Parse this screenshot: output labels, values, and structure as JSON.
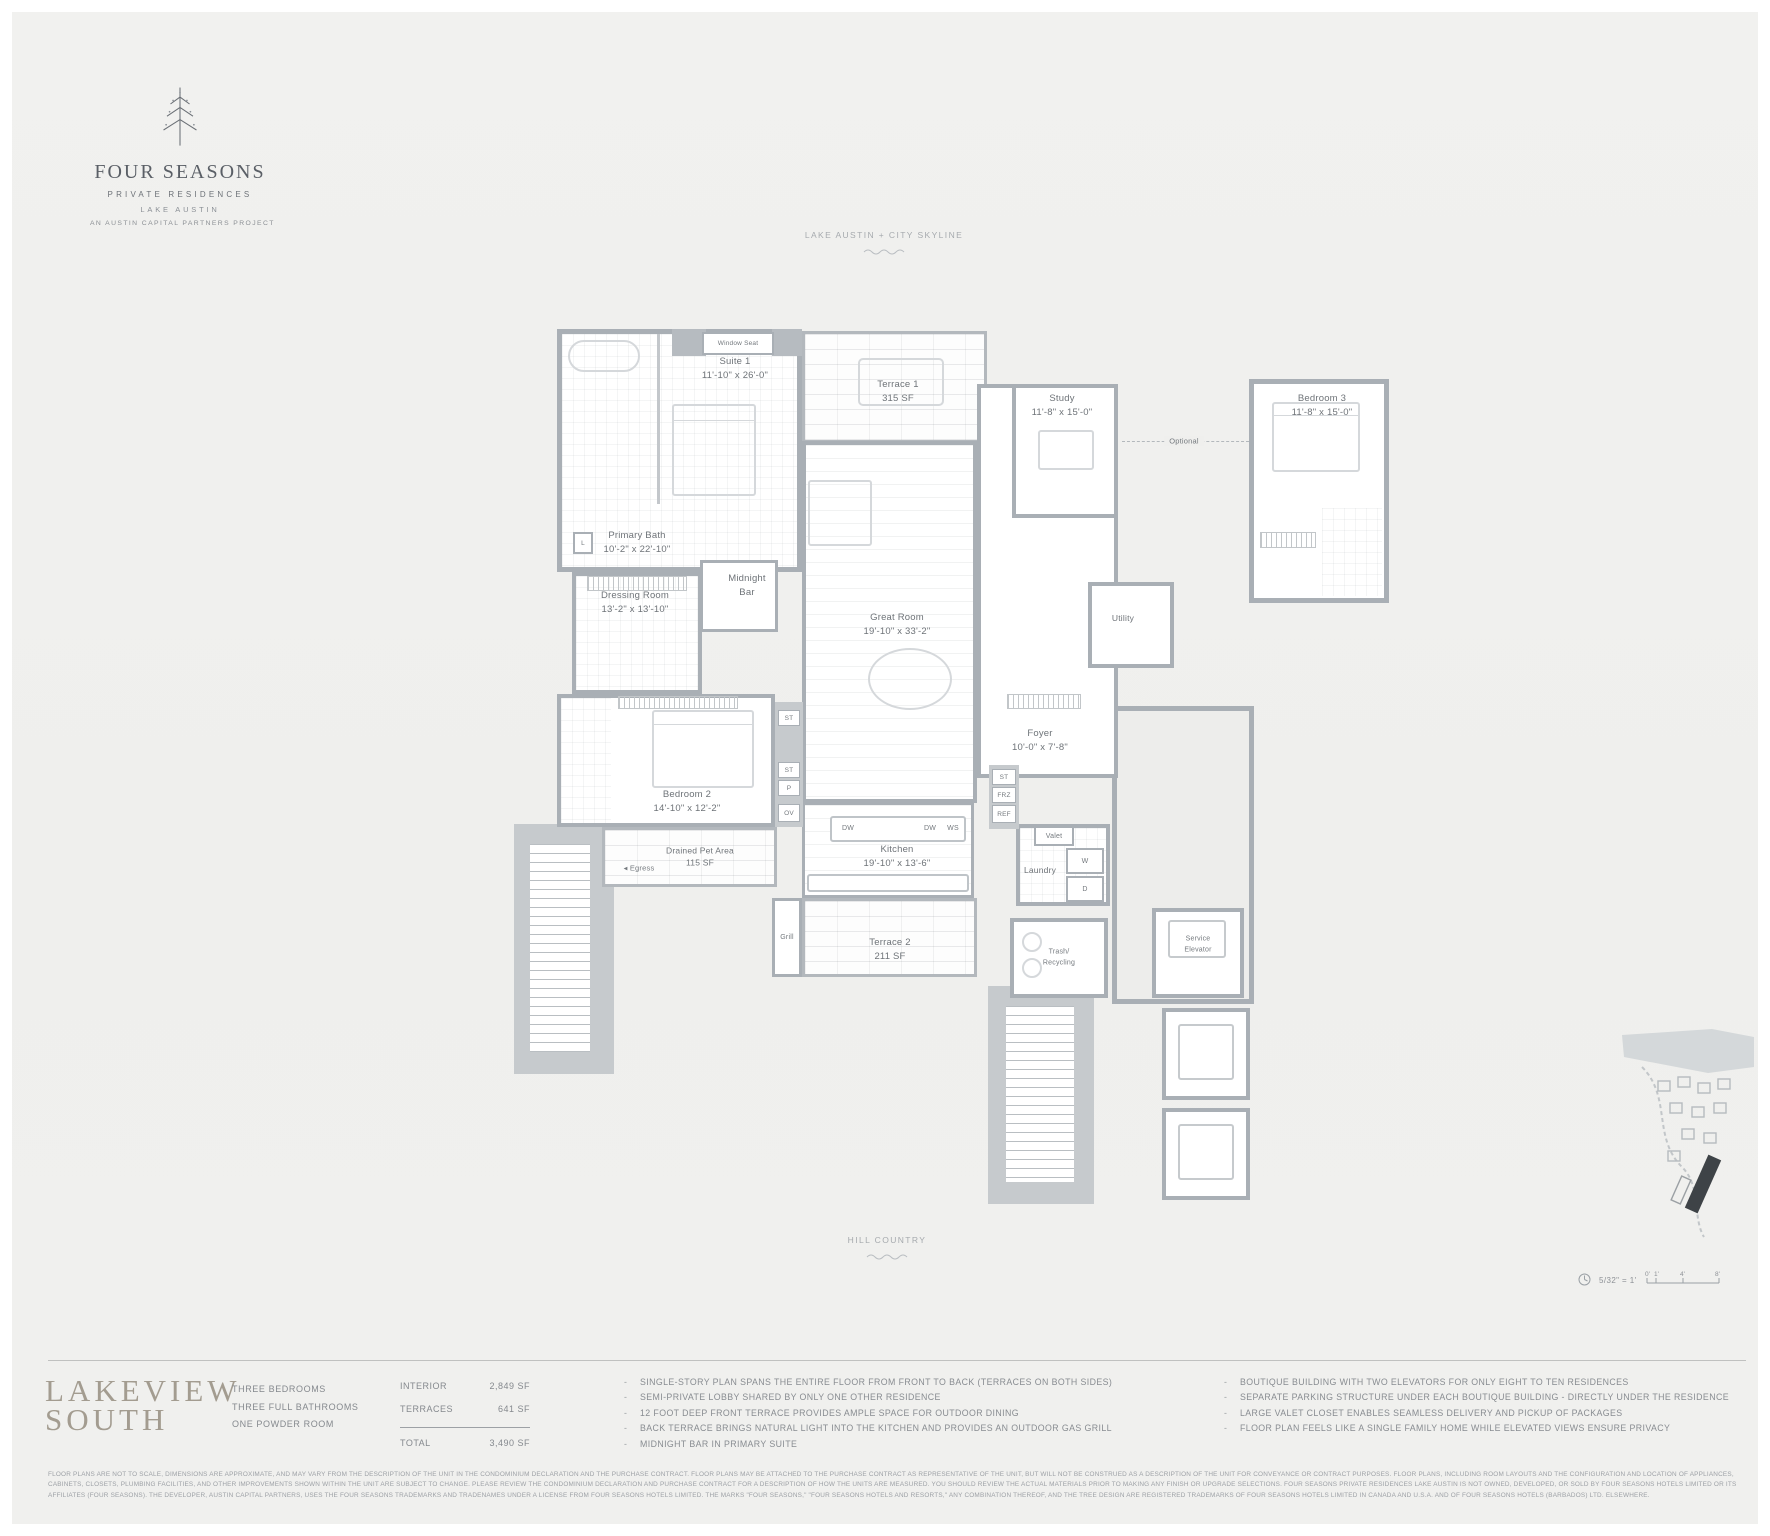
{
  "brand": {
    "four_seasons": "Four Seasons",
    "private_residences": "PRIVATE RESIDENCES",
    "lake_austin": "LAKE AUSTIN",
    "project": "AN AUSTIN CAPITAL PARTNERS PROJECT"
  },
  "orientation": {
    "top": "LAKE AUSTIN + CITY SKYLINE",
    "bottom": "HILL COUNTRY"
  },
  "plan": {
    "rooms": {
      "suite1": {
        "name": "Suite 1",
        "dims": "11'-10\" x 26'-0\""
      },
      "primary_bath": {
        "name": "Primary Bath",
        "dims": "10'-2\" x 22'-10\""
      },
      "dressing": {
        "name": "Dressing Room",
        "dims": "13'-2\" x 13'-10\""
      },
      "midnight_bar": {
        "line1": "Midnight",
        "line2": "Bar"
      },
      "great_room": {
        "name": "Great Room",
        "dims": "19'-10\" x 33'-2\""
      },
      "study": {
        "name": "Study",
        "dims": "11'-8\" x 15'-0\""
      },
      "bedroom3": {
        "name": "Bedroom 3",
        "dims": "11'-8\" x 15'-0\""
      },
      "bedroom2": {
        "name": "Bedroom 2",
        "dims": "14'-10\" x 12'-2\""
      },
      "pet_area": {
        "name": "Drained Pet Area",
        "dims": "115 SF"
      },
      "kitchen": {
        "name": "Kitchen",
        "dims": "19'-10\" x 13'-6\""
      },
      "terrace1": {
        "name": "Terrace 1",
        "dims": "315 SF"
      },
      "terrace2": {
        "name": "Terrace 2",
        "dims": "211 SF"
      },
      "foyer": {
        "name": "Foyer",
        "dims": "10'-0\" x 7'-8\""
      },
      "laundry": {
        "name": "Laundry"
      },
      "utility": {
        "name": "Utility"
      },
      "trash": {
        "line1": "Trash/",
        "line2": "Recycling"
      },
      "service_elevator": {
        "line1": "Service",
        "line2": "Elevator"
      }
    },
    "tags": {
      "l": "L",
      "st": "ST",
      "p": "P",
      "ov": "OV",
      "dw": "DW",
      "ws": "WS",
      "frz": "FRZ",
      "ref": "REF",
      "w": "W",
      "d": "D",
      "valet": "Valet",
      "grill": "Grill",
      "egress": "Egress",
      "window_seat": "Window Seat",
      "optional": "Optional"
    },
    "scale": {
      "ratio": "5/32\" = 1'",
      "ticks": [
        "0'",
        "1'",
        "4'",
        "8'"
      ]
    }
  },
  "unit": {
    "name_line1": "LAKEVIEW",
    "name_line2": "SOUTH",
    "specs": [
      "THREE BEDROOMS",
      "THREE FULL BATHROOMS",
      "ONE POWDER ROOM"
    ],
    "areas": {
      "interior_label": "INTERIOR",
      "interior_value": "2,849 SF",
      "terraces_label": "TERRACES",
      "terraces_value": "641 SF",
      "total_label": "TOTAL",
      "total_value": "3,490 SF"
    },
    "features_left": [
      "SINGLE-STORY PLAN SPANS THE ENTIRE FLOOR FROM FRONT TO BACK (TERRACES ON BOTH SIDES)",
      "SEMI-PRIVATE LOBBY SHARED BY ONLY ONE OTHER RESIDENCE",
      "12 FOOT DEEP FRONT TERRACE PROVIDES AMPLE SPACE FOR OUTDOOR DINING",
      "BACK TERRACE BRINGS NATURAL LIGHT INTO THE KITCHEN AND PROVIDES AN OUTDOOR GAS GRILL",
      "MIDNIGHT BAR IN PRIMARY SUITE"
    ],
    "features_right": [
      "BOUTIQUE BUILDING WITH TWO ELEVATORS FOR ONLY EIGHT TO TEN RESIDENCES",
      "SEPARATE PARKING STRUCTURE UNDER EACH BOUTIQUE BUILDING - DIRECTLY UNDER THE RESIDENCE",
      "LARGE VALET CLOSET ENABLES SEAMLESS DELIVERY AND PICKUP OF PACKAGES",
      "FLOOR PLAN FEELS LIKE A SINGLE FAMILY HOME WHILE ELEVATED VIEWS ENSURE PRIVACY"
    ]
  },
  "legal": "FLOOR PLANS ARE NOT TO SCALE, DIMENSIONS ARE APPROXIMATE, AND MAY VARY FROM THE DESCRIPTION OF THE UNIT IN THE CONDOMINIUM DECLARATION AND THE PURCHASE CONTRACT. FLOOR PLANS MAY BE ATTACHED TO THE PURCHASE CONTRACT AS REPRESENTATIVE OF THE UNIT, BUT WILL NOT BE CONSTRUED AS A DESCRIPTION OF THE UNIT FOR CONVEYANCE OR CONTRACT PURPOSES. FLOOR PLANS, INCLUDING ROOM LAYOUTS AND THE CONFIGURATION AND LOCATION OF APPLIANCES, CABINETS, CLOSETS, PLUMBING FACILITIES, AND OTHER IMPROVEMENTS SHOWN WITHIN THE UNIT ARE SUBJECT TO CHANGE. PLEASE REVIEW THE CONDOMINIUM DECLARATION AND PURCHASE CONTRACT FOR A DESCRIPTION OF HOW THE UNITS ARE MEASURED. YOU SHOULD REVIEW THE ACTUAL MATERIALS PRIOR TO MAKING ANY FINISH OR UPGRADE SELECTIONS. FOUR SEASONS PRIVATE RESIDENCES LAKE AUSTIN IS NOT OWNED, DEVELOPED, OR SOLD BY FOUR SEASONS HOTELS LIMITED OR ITS AFFILIATES (FOUR SEASONS). THE DEVELOPER, AUSTIN CAPITAL PARTNERS, USES THE FOUR SEASONS TRADEMARKS AND TRADENAMES UNDER A LICENSE FROM FOUR SEASONS HOTELS LIMITED. THE MARKS \"FOUR SEASONS,\" \"FOUR SEASONS HOTELS AND RESORTS,\" ANY COMBINATION THEREOF, AND THE TREE DESIGN ARE REGISTERED TRADEMARKS OF FOUR SEASONS HOTELS LIMITED IN CANADA AND U.S.A. AND OF FOUR SEASONS HOTELS (BARBADOS) LTD. ELSEWHERE."
}
